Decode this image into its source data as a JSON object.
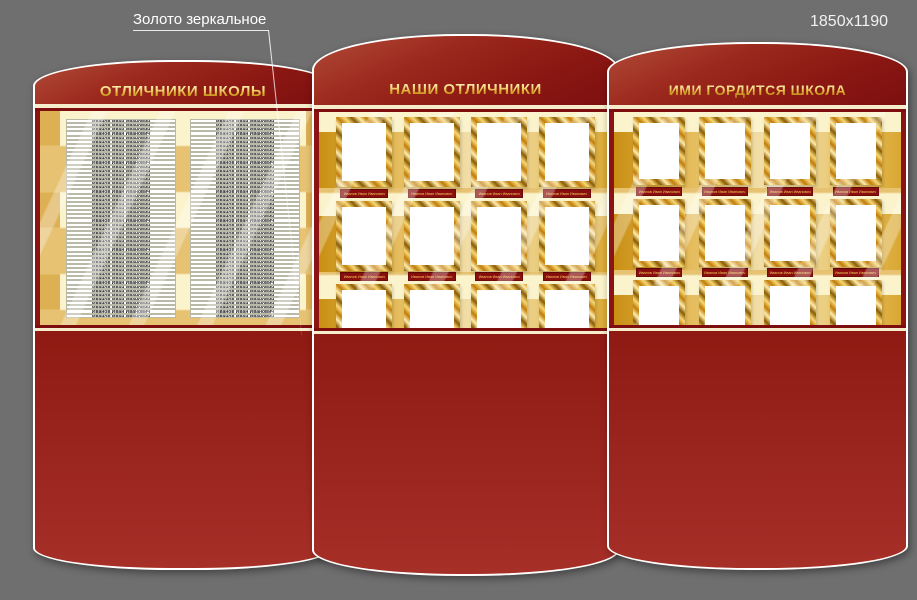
{
  "annotations": {
    "material_note": "Золото зеркальное",
    "board_size": "1850x1190",
    "photo_size": "100x150"
  },
  "colors": {
    "background": "#6f6f6f",
    "panel_red": "#8f1a13",
    "cream": "#fbf3cc",
    "gold": "#d6961b",
    "gold_light": "#f3d87e",
    "nameplate_red": "#8c0f0f",
    "title_gold": "#e7bb45"
  },
  "panels": {
    "left": {
      "title": "ОТЛИЧНИКИ ШКОЛЫ",
      "columns": 2,
      "rows_per_column": 48,
      "name_placeholder": "Иванов Иван Иванович"
    },
    "middle": {
      "title": "НАШИ ОТЛИЧНИКИ",
      "photo_rows": 5,
      "photos_per_row": 4,
      "caption_placeholder": "Иванов Иван Иванович"
    },
    "right": {
      "title": "ИМИ ГОРДИТСЯ ШКОЛА",
      "photo_rows": 5,
      "photos_per_row": 4,
      "caption_placeholder": "Иванов Иван Иванович"
    }
  }
}
